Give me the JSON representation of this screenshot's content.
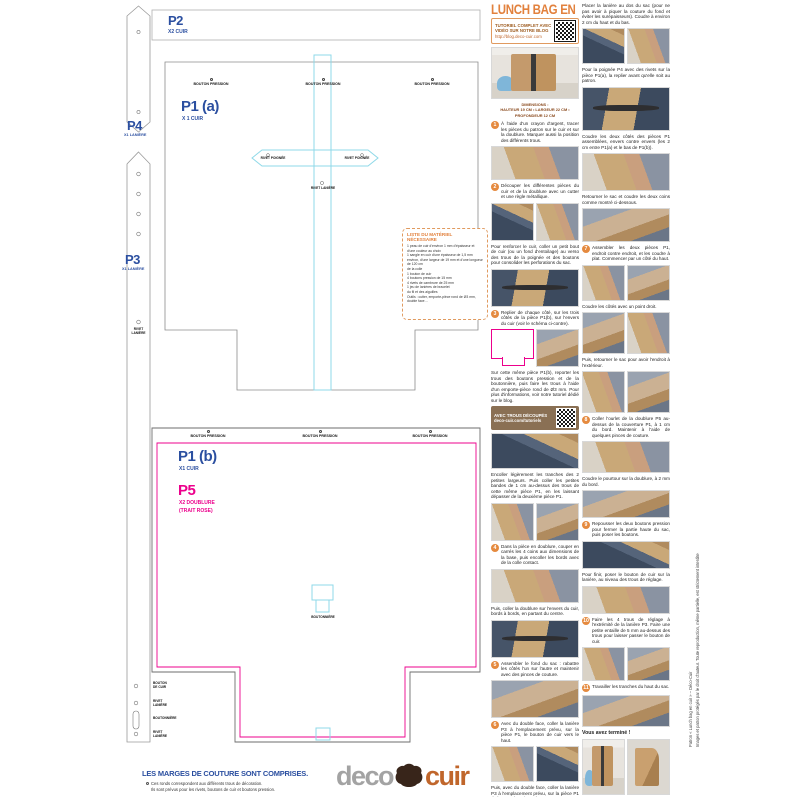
{
  "colors": {
    "blue": "#2b4fa0",
    "pink": "#ec008c",
    "cyan": "#8fd9e8",
    "orange": "#e2813d",
    "tan_box": "#8a7054"
  },
  "pattern": {
    "p2": {
      "label": "P2",
      "sub": "X2 CUIR"
    },
    "p1a": {
      "label": "P1 (a)",
      "sub": "X 1 CUIR"
    },
    "p1b": {
      "label": "P1 (b)",
      "sub": "X1 CUIR"
    },
    "p5": {
      "label": "P5",
      "sub": "X2 DOUBLURE",
      "sub2": "(TRAIT ROSE)"
    },
    "p3": {
      "label": "P3",
      "sub": "X1 LANIÈRE"
    },
    "p4": {
      "label": "P4",
      "sub": "X1 LANIÈRE"
    },
    "markers": {
      "bouton_pression": "BOUTON PRESSION",
      "rivet_poignee": "RIVET POIGNÉE",
      "rivet_laniere": "RIVET LANIÈRE",
      "rivet_laniere_l1": "RIVET",
      "rivet_laniere_l2": "LANIÈRE",
      "boutonniere": "BOUTONNIÈRE",
      "bouton_cuir_l1": "BOUTON",
      "bouton_cuir_l2": "DE CUIR"
    },
    "materials": {
      "title": "LISTE DU MATÉRIEL NÉCESSAIRE",
      "items": [
        "1 peau de cuir d'environ 1 mm d'épaisseur et d'une couleur au choix",
        "1 sangle en cuir d'une épaisseur de 1,5 mm environ, d'une largeur de 19 mm et d'une longueur de 120 cm",
        "de la colle",
        "1 bouton de cuir",
        "4 boutons pression de 15 mm",
        "4 rivets de cambrure de 25 mm",
        "1 jeu de lanières de bracelet",
        "du fil et des aiguilles",
        "Outils : cutter, emporte-pièce rond de Ø3 mm, double face…"
      ]
    },
    "footer": {
      "notice": "LES MARGES DE COUTURE SONT COMPRISES.",
      "note1": "Ces ronds correspondent aux différents trous de décoration.",
      "note2": "Ils sont prévus pour les rivets, boutons de cuir et boutons pression."
    },
    "logo": {
      "part1": "deco",
      "part2": "cuir"
    }
  },
  "tutorial": {
    "title": "LUNCH BAG EN CUIR",
    "qr_box": {
      "line1": "TUTORIEL COMPLET AVEC",
      "line2": "VIDÉO SUR NOTRE BLOG",
      "url": "http://blog.deco-cuir.com"
    },
    "col1": [
      {
        "type": "photo",
        "v": "bag",
        "h": 52
      },
      {
        "type": "cap",
        "line1": "DIMENSIONS :",
        "line2": "HAUTEUR 19 CM • LARGEUR 22 CM • PROFONDEUR 12 CM"
      },
      {
        "type": "text",
        "num": "1",
        "text": "À l'aide d'un crayon d'argent, tracer les pièces du patron sur le cuir et sur la doublure. Marquer aussi la position des différents trous."
      },
      {
        "type": "photo",
        "v": "work",
        "h": 34
      },
      {
        "type": "text",
        "num": "2",
        "text": "Découper les différentes pièces du cuir et de la doublure avec un cutter et une règle métallique."
      },
      {
        "type": "pair",
        "v1": "mat",
        "v2": "work",
        "h": 38
      },
      {
        "type": "text",
        "text": "Pour renforcer le cuir, coller un petit bout de cuir (ou un fond d'entoilage) au verso des trous de la poignée et des boutons pour consolider les perforations du sac."
      },
      {
        "type": "photo",
        "v": "mat2",
        "h": 38
      },
      {
        "type": "text",
        "num": "3",
        "text": "Replier de chaque côté, sur les trois côtés de la pièce P1(b), sur l'envers du cuir (voir le schéma ci-contre)."
      },
      {
        "type": "diag",
        "v2": "work2",
        "h": 38
      },
      {
        "type": "text",
        "text": "Sur cette même pièce P1(b), reporter les trous des boutons pression et de la boutonnière, puis faire les trous à l'aide d'un emporte-pièce rond de Ø3 mm. Pour plus d'informations, voir notre tutoriel dédié sur le blog."
      },
      {
        "type": "qr2",
        "line1": "AVEC TROUS DÉCOUPÉS",
        "line2": "deco-cuir.com/tutoriels"
      },
      {
        "type": "photo",
        "v": "mat",
        "h": 36
      },
      {
        "type": "text",
        "text": "Encoller légèrement les tranches des 2 petites largeurs. Puis coller les petites bandes de 1 cm au-dessus des trous de cette même pièce P1, en les laissant dépasser de la deuxième pièce P1."
      },
      {
        "type": "pair",
        "v1": "work",
        "v2": "work2",
        "h": 38
      },
      {
        "type": "text",
        "num": "4",
        "text": "Dans la pièce en doublure, couper en carrés les 4 coins aux dimensions de la base, puis encoller les bords avec de la colle contact."
      },
      {
        "type": "photo",
        "v": "work",
        "h": 34
      },
      {
        "type": "text",
        "text": "Puis, coller la doublure sur l'envers du cuir, bords à bords, en partant du centre."
      },
      {
        "type": "photo",
        "v": "mat2",
        "h": 38
      },
      {
        "type": "text",
        "num": "5",
        "text": "Assembler le fond du sac : rabattre les côtés l'un sur l'autre et maintenir avec des pinces de couture."
      },
      {
        "type": "photo",
        "v": "work2",
        "h": 38
      },
      {
        "type": "text",
        "num": "6",
        "text": "Avec du double face, coller la lanière P3 à l'emplacement prévu, sur la pièce P1, le bouton de cuir vers le haut."
      },
      {
        "type": "pair",
        "v1": "work",
        "v2": "mat",
        "h": 36
      },
      {
        "type": "text",
        "text": "Puis, avec du double face, coller la lanière P3 à l'emplacement prévu, sur la pièce P1 du bouton de cuir au dos."
      },
      {
        "type": "photo",
        "v": "work",
        "h": 30
      }
    ],
    "col2": [
      {
        "type": "text",
        "text": "Placer la lanière au dos du sac (pour ne pas avoir à piquer la couture du fond et éviter les surépaisseurs). Coudre à environ 2 cm du haut et du bas."
      },
      {
        "type": "pair",
        "v1": "mat",
        "v2": "work",
        "h": 36
      },
      {
        "type": "text",
        "text": "Pour la poignée P4 avec des rivets sur la pièce P1(a), la replier avant qu'elle soit au patron."
      },
      {
        "type": "photo",
        "v": "mat2",
        "h": 44
      },
      {
        "type": "text",
        "text": "Coudre les deux côtés des pièces P1 assemblées, envers contre envers (les 2 cm entre P1(a) et le bas de P1(b))."
      },
      {
        "type": "photo",
        "v": "work",
        "h": 38
      },
      {
        "type": "text",
        "text": "Retourner le sac et coudre les deux coins comme montré ci-dessous."
      },
      {
        "type": "photo",
        "v": "work2",
        "h": 34
      },
      {
        "type": "text",
        "num": "7",
        "text": "Assembler les deux pièces P1, endroit contre endroit, et les coudre à plat. Commencer par un côté du haut."
      },
      {
        "type": "pair",
        "v1": "work",
        "v2": "work2",
        "h": 36
      },
      {
        "type": "text",
        "text": "Coudre les côtés avec un point droit."
      },
      {
        "type": "pair",
        "v1": "work2",
        "v2": "work",
        "h": 42
      },
      {
        "type": "text",
        "text": "Puis, retourner le sac pour avoir l'endroit à l'extérieur."
      },
      {
        "type": "pair",
        "v1": "work",
        "v2": "work2",
        "h": 42
      },
      {
        "type": "text",
        "num": "8",
        "text": "Coller l'ourlet de la doublure P5 au-dessus de la couverture P1, à 1 cm du bord. Maintenir à l'aide de quelques pinces de couture."
      },
      {
        "type": "photo",
        "v": "work",
        "h": 32
      },
      {
        "type": "text",
        "text": "Coudre le pourtour sur la doublure, à 2 mm du bord."
      },
      {
        "type": "photo",
        "v": "work2",
        "h": 28
      },
      {
        "type": "text",
        "num": "9",
        "text": "Repousser les deux boutons pression pour fermer la partie haute du sac, puis poser les boutons."
      },
      {
        "type": "photo",
        "v": "mat",
        "h": 28
      },
      {
        "type": "text",
        "text": "Pour finir, poser le bouton de cuir sur la lanière, au niveau des trous de réglage."
      },
      {
        "type": "photo",
        "v": "work",
        "h": 28
      },
      {
        "type": "text",
        "num": "10",
        "text": "Faire les 4 trous de réglage à l'extrémité de la lanière P3. Faire une petite entaille de 5 mm au-dessus des trous pour laisser passer le bouton de cuir."
      },
      {
        "type": "pair",
        "v1": "work",
        "v2": "work2",
        "h": 34
      },
      {
        "type": "text",
        "num": "11",
        "text": "Travailler les tranches du haut du sac."
      },
      {
        "type": "photo",
        "v": "work2",
        "h": 32
      },
      {
        "type": "msg",
        "text": "Vous avez terminé !"
      },
      {
        "type": "pair",
        "v1": "bag",
        "v2": "bag2",
        "h": 56
      }
    ],
    "copyright1": "Patron « Lunch bag en cuir » – Déco-Cuir",
    "copyright2": "Images et patron protégés par le droit d'auteur. Toute reproduction, même partielle, est strictement interdite sans notre accord."
  }
}
